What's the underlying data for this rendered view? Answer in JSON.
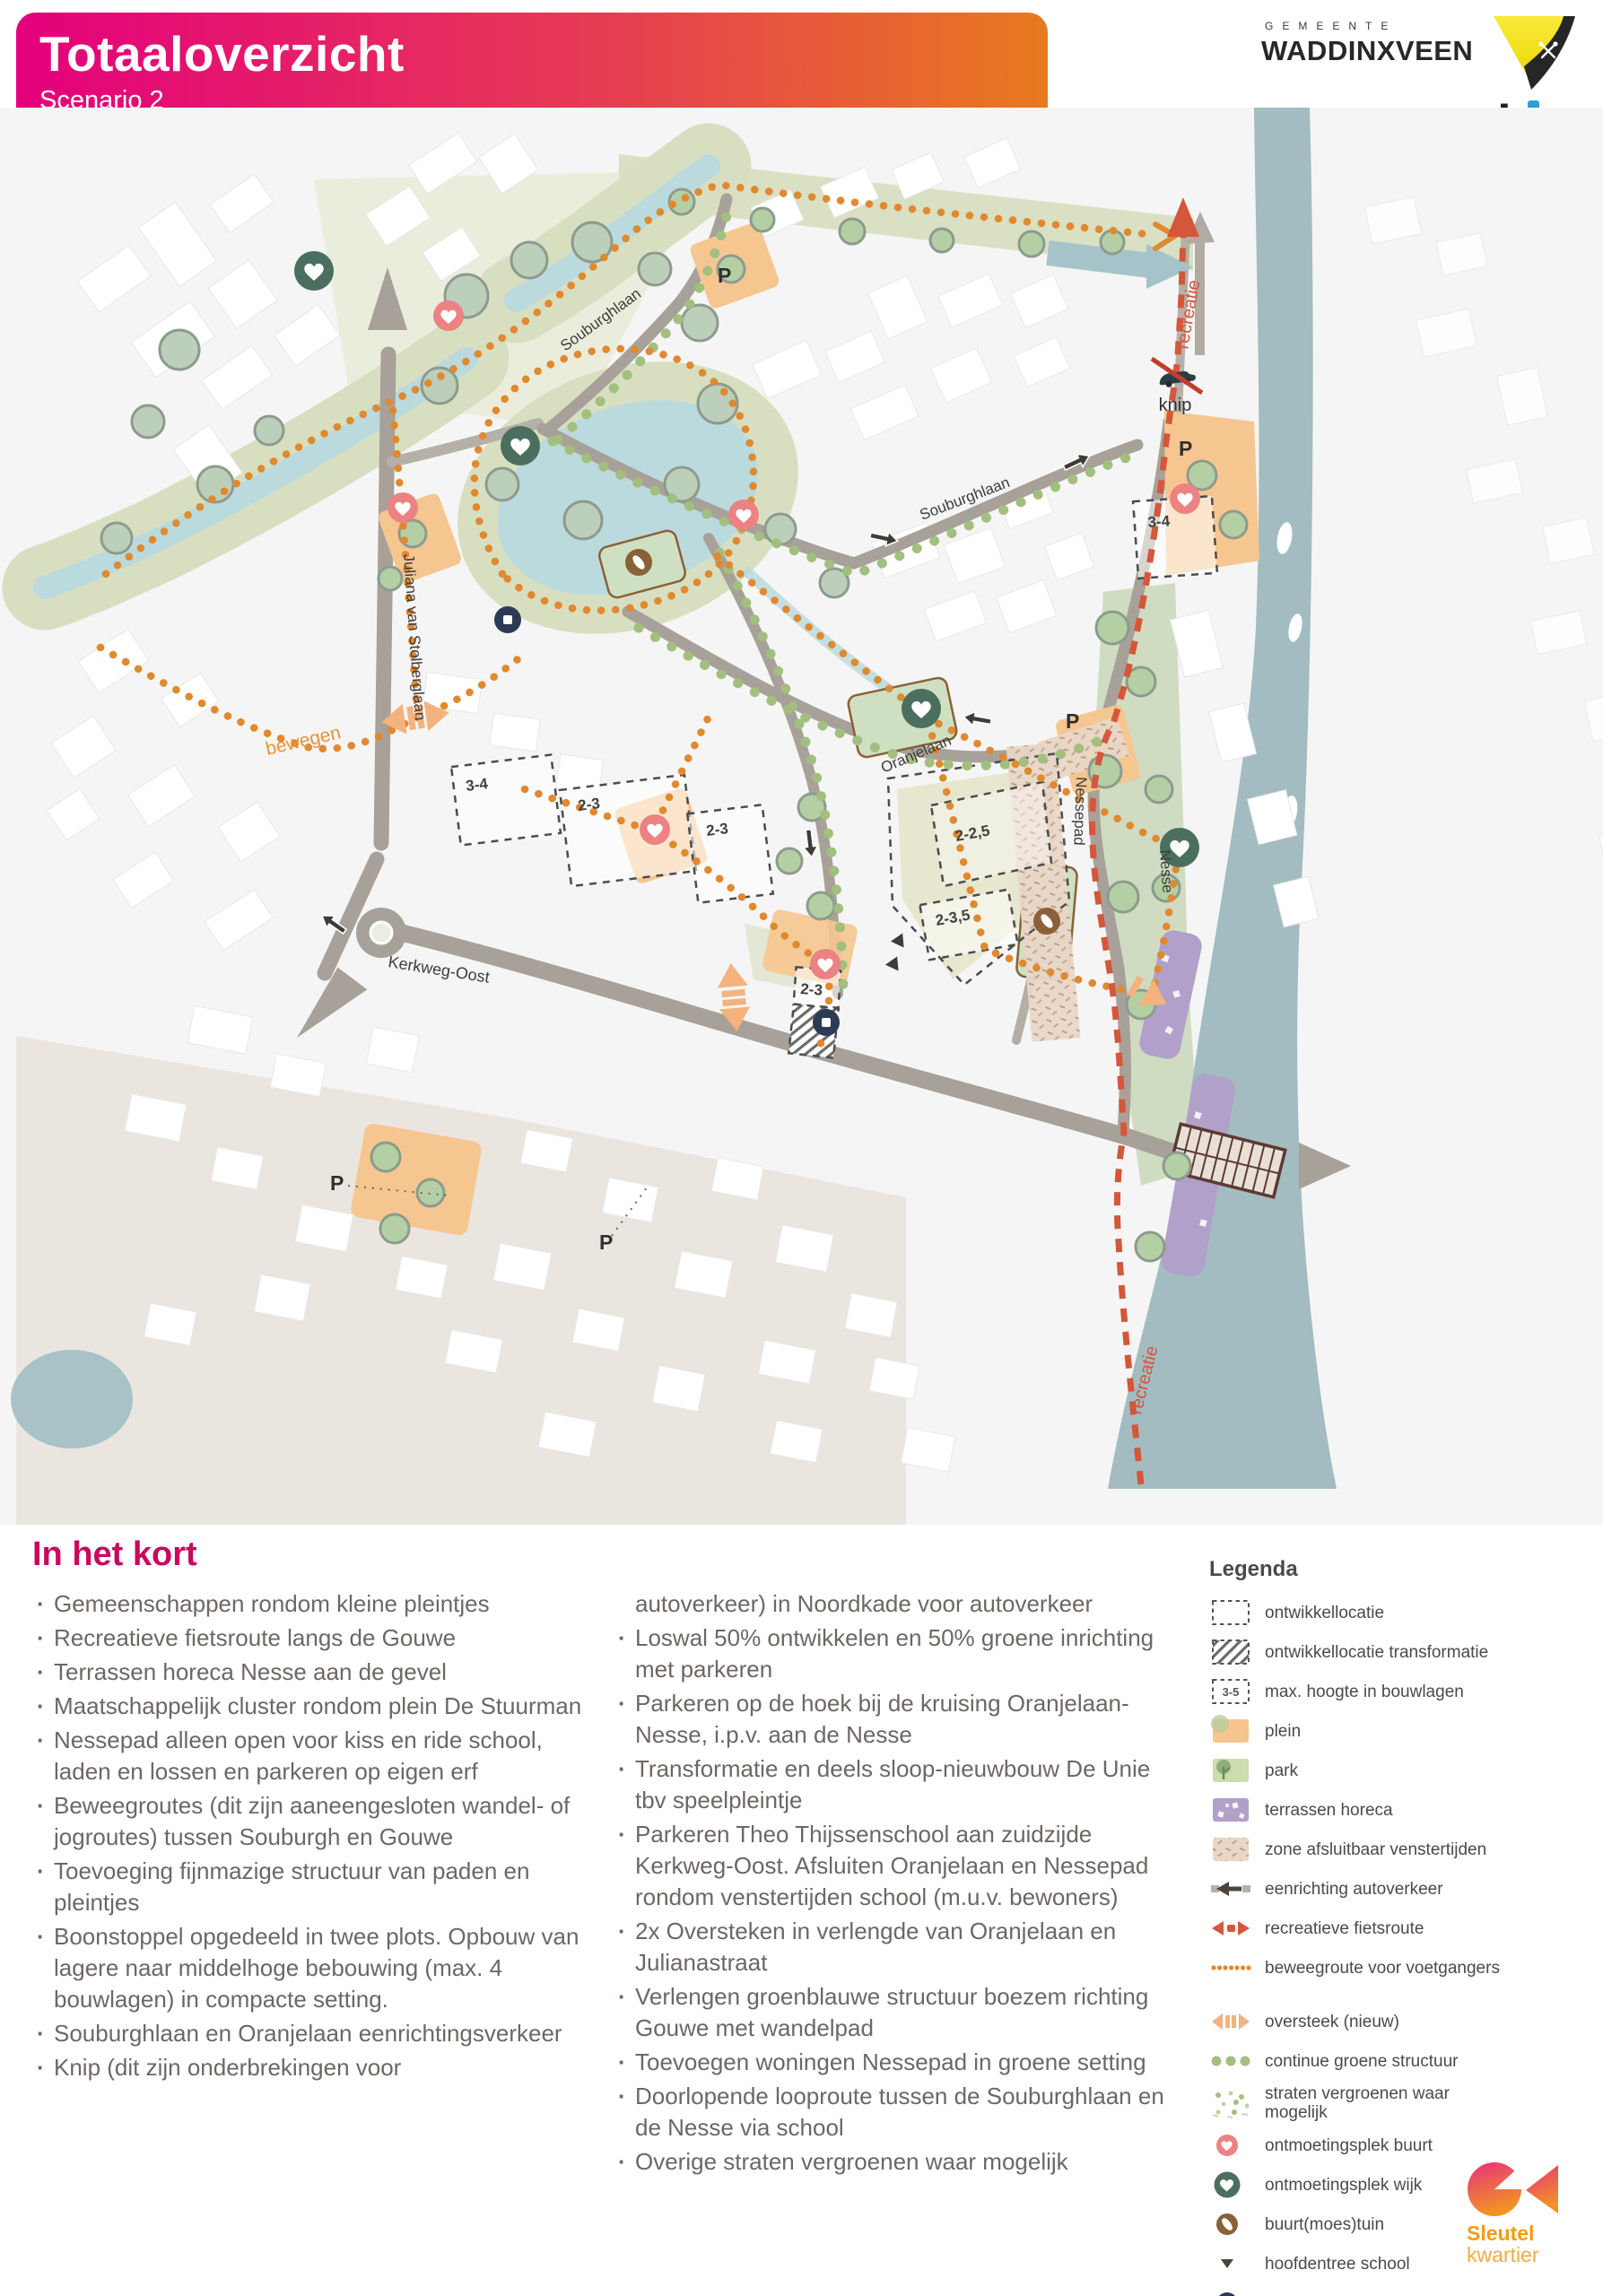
{
  "header": {
    "title": "Totaaloverzicht",
    "subtitle": "Scenario 2"
  },
  "logos": {
    "gemeente_top": "GEMEENTE",
    "gemeente": "WADDINXVEEN",
    "urbis_parts": {
      "pre": "urb",
      "i_dotless": "ı",
      "post": "s"
    },
    "sleutel": "Sleutel",
    "kwartier": "kwartier"
  },
  "map": {
    "streets": {
      "juliana": "Juliana van Stolberglaan",
      "souburghlaan_a": "Souburghlaan",
      "souburghlaan_b": "Souburghlaan",
      "oranjelaan": "Oranjelaan",
      "kerkweg": "Kerkweg-Oost",
      "nessepad": "Nessepad",
      "nesse": "Nesse"
    },
    "routes": {
      "bewegen": "bewegen",
      "recreatie_top": "recreatie",
      "recreatie_bottom": "recreatie"
    },
    "markers": {
      "knip": "knip",
      "parking": "P"
    },
    "heights": {
      "a": "3-4",
      "b": "2-3",
      "c": "2-3",
      "d": "2-3",
      "e": "2-2,5",
      "f": "2-3,5",
      "g": "3-4"
    }
  },
  "in_het_kort": {
    "heading": "In het kort",
    "left": [
      "Gemeenschappen rondom kleine pleintjes",
      "Recreatieve fietsroute langs de Gouwe",
      "Terrassen horeca Nesse aan de gevel",
      "Maatschappelijk cluster rondom plein De Stuurman",
      "Nessepad alleen open voor kiss en ride school, laden en lossen en parkeren op eigen erf",
      "Beweegroutes (dit zijn aaneengesloten wandel- of jogroutes) tussen Souburgh en Gouwe",
      "Toevoeging fijnmazige structuur van paden en pleintjes",
      "Boonstoppel opgedeeld in twee plots. Opbouw van lagere naar middelhoge bebouwing (max. 4 bouwlagen) in compacte setting.",
      "Souburghlaan en Oranjelaan eenrichtingsverkeer",
      "Knip (dit zijn onderbrekingen voor"
    ],
    "right_continuation": "autoverkeer) in Noordkade voor autoverkeer",
    "right": [
      "Loswal 50% ontwikkelen en 50% groene inrichting met parkeren",
      "Parkeren op de hoek bij de kruising Oranjelaan-Nesse, i.p.v. aan de Nesse",
      "Transformatie en deels sloop-nieuwbouw De Unie tbv speelpleintje",
      "Parkeren Theo Thijssenschool aan zuidzijde Kerkweg-Oost. Afsluiten Oranjelaan en Nessepad rondom venstertijden school (m.u.v. bewoners)",
      "2x Oversteken in verlengde van Oranjelaan en Julianastraat",
      "Verlengen groenblauwe structuur boezem richting Gouwe met wandelpad",
      "Toevoegen woningen Nessepad in groene setting",
      "Doorlopende looproute tussen de Souburghlaan en de Nesse via school",
      "Overige straten vergroenen waar mogelijk"
    ]
  },
  "legend": {
    "heading": "Legenda",
    "box_label": "3-5",
    "items": [
      "ontwikkellocatie",
      "ontwikkellocatie transformatie",
      "max. hoogte in bouwlagen",
      "plein",
      "park",
      "terrassen horeca",
      "zone afsluitbaar venstertijden",
      "eenrichting autoverkeer",
      "recreatieve fietsroute",
      "beweegroute voor voetgangers",
      "oversteek (nieuw)",
      "continue groene structuur",
      "straten vergroenen waar mogelijk",
      "ontmoetingsplek buurt",
      "ontmoetingsplek wijk",
      "buurt(moes)tuin",
      "hoofdentree school",
      "mogelijk nieuwe functie"
    ]
  }
}
